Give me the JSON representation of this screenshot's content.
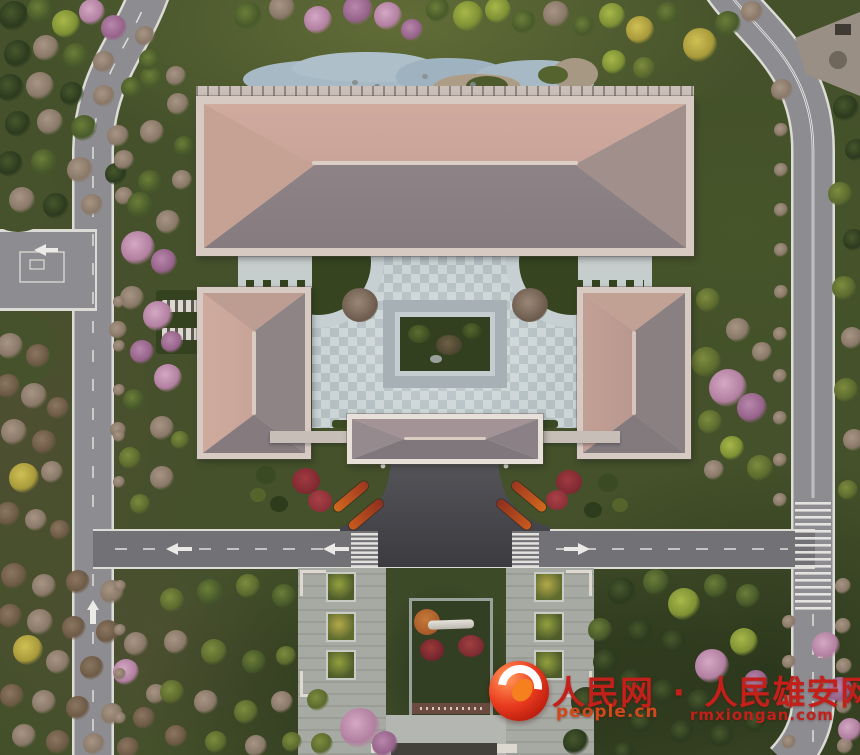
{
  "watermark": {
    "brand_left": "人民网",
    "separator": "·",
    "brand_right": "人民雄安网",
    "site_left": "people.cn",
    "site_right": "rmxiongan.com",
    "red": "#c3201b",
    "orange": "#d0491d"
  },
  "scene": {
    "subject": "Dusk aerial view of a traditional hip-roof hall compound with courtyard, gate pavilion, pond, south memorial lawn and perimeter roads",
    "elements": {
      "main_hall": "large hip-roof main hall",
      "west_wing": "west wing hall",
      "east_wing": "east wing hall",
      "gate_pavilion": "entrance gate pavilion",
      "courtyard": "checker-paved courtyard with sunken central garden",
      "pond": "curved landscape pond",
      "memorial": "south lawn with white stone monument and red shrubs",
      "roads": "loop road, T-junctions, zebra crosswalks, lane arrows"
    },
    "colors": {
      "lawn": "#44512a",
      "road": "#8d8c90",
      "road_dark": "#727176",
      "asphalt_drive": "#45444a",
      "roof_lit": "#c9a395",
      "roof_shade": "#8e8385",
      "eave": "#d6cac3",
      "paving": "#c4ced1",
      "water": "#a7b9c4",
      "flower_red": "#8e2f35",
      "flower_orange": "#c8541e"
    }
  },
  "trees": {
    "palette": [
      {
        "base": "#2c3a1e",
        "hi": "#47582c"
      },
      {
        "base": "#485a2a",
        "hi": "#6c7e38"
      },
      {
        "base": "#7e9034",
        "hi": "#a8b84a"
      },
      {
        "base": "#a89a3a",
        "hi": "#cfc055"
      },
      {
        "base": "#b27fa0",
        "hi": "#d4a8c4"
      },
      {
        "base": "#96628a",
        "hi": "#b887ab"
      },
      {
        "base": "#6d5a46",
        "hi": "#8b7660"
      },
      {
        "base": "#a05526",
        "hi": "#c47a3a"
      },
      {
        "base": "#5c6a2e",
        "hi": "#7d8c3e"
      },
      {
        "base": "#897868",
        "hi": "#a89584"
      }
    ],
    "items": [
      [
        14,
        16,
        15,
        0
      ],
      [
        40,
        10,
        13,
        1
      ],
      [
        66,
        24,
        14,
        2
      ],
      [
        92,
        12,
        13,
        4
      ],
      [
        114,
        28,
        13,
        5
      ],
      [
        18,
        54,
        14,
        0
      ],
      [
        46,
        48,
        13,
        9
      ],
      [
        76,
        56,
        13,
        1
      ],
      [
        104,
        62,
        11,
        9
      ],
      [
        10,
        88,
        14,
        0
      ],
      [
        40,
        86,
        14,
        9
      ],
      [
        72,
        94,
        12,
        0
      ],
      [
        104,
        96,
        11,
        9
      ],
      [
        132,
        88,
        11,
        1
      ],
      [
        18,
        124,
        13,
        0
      ],
      [
        50,
        122,
        13,
        9
      ],
      [
        84,
        128,
        13,
        1
      ],
      [
        118,
        136,
        11,
        9
      ],
      [
        10,
        164,
        13,
        0
      ],
      [
        44,
        162,
        13,
        1
      ],
      [
        80,
        170,
        13,
        9
      ],
      [
        116,
        174,
        11,
        0
      ],
      [
        22,
        200,
        13,
        9
      ],
      [
        56,
        206,
        13,
        0
      ],
      [
        92,
        205,
        11,
        9
      ],
      [
        145,
        36,
        10,
        9
      ],
      [
        152,
        78,
        12,
        1
      ],
      [
        178,
        104,
        11,
        9
      ],
      [
        152,
        132,
        12,
        9
      ],
      [
        184,
        146,
        10,
        1
      ],
      [
        124,
        160,
        10,
        9
      ],
      [
        150,
        182,
        12,
        1
      ],
      [
        182,
        180,
        10,
        9
      ],
      [
        150,
        60,
        11,
        1
      ],
      [
        176,
        76,
        10,
        9
      ],
      [
        124,
        196,
        9,
        9
      ],
      [
        140,
        205,
        13,
        1
      ],
      [
        168,
        222,
        12,
        9
      ],
      [
        138,
        248,
        17,
        4
      ],
      [
        164,
        262,
        13,
        5
      ],
      [
        132,
        298,
        12,
        9
      ],
      [
        158,
        316,
        15,
        4
      ],
      [
        172,
        342,
        11,
        5
      ],
      [
        142,
        352,
        12,
        5
      ],
      [
        168,
        378,
        14,
        4
      ],
      [
        134,
        400,
        11,
        1
      ],
      [
        162,
        428,
        12,
        9
      ],
      [
        130,
        458,
        11,
        8
      ],
      [
        162,
        478,
        12,
        9
      ],
      [
        140,
        504,
        10,
        8
      ],
      [
        180,
        440,
        9,
        8
      ],
      [
        118,
        430,
        8,
        9
      ],
      [
        118,
        330,
        9,
        9
      ],
      [
        10,
        346,
        13,
        9
      ],
      [
        38,
        356,
        12,
        6
      ],
      [
        8,
        386,
        12,
        6
      ],
      [
        34,
        396,
        13,
        9
      ],
      [
        58,
        408,
        11,
        6
      ],
      [
        14,
        432,
        13,
        9
      ],
      [
        44,
        442,
        12,
        6
      ],
      [
        24,
        478,
        15,
        3
      ],
      [
        52,
        472,
        11,
        9
      ],
      [
        8,
        514,
        12,
        6
      ],
      [
        36,
        520,
        11,
        9
      ],
      [
        60,
        530,
        10,
        6
      ],
      [
        248,
        16,
        14,
        1
      ],
      [
        282,
        8,
        13,
        9
      ],
      [
        318,
        20,
        14,
        4
      ],
      [
        358,
        10,
        15,
        5
      ],
      [
        388,
        16,
        14,
        4
      ],
      [
        412,
        30,
        11,
        5
      ],
      [
        438,
        10,
        12,
        1
      ],
      [
        468,
        16,
        15,
        2
      ],
      [
        498,
        10,
        13,
        2
      ],
      [
        524,
        22,
        12,
        1
      ],
      [
        556,
        14,
        13,
        9
      ],
      [
        584,
        26,
        11,
        1
      ],
      [
        612,
        16,
        13,
        2
      ],
      [
        640,
        30,
        14,
        3
      ],
      [
        668,
        14,
        12,
        1
      ],
      [
        700,
        45,
        17,
        3
      ],
      [
        728,
        24,
        13,
        1
      ],
      [
        752,
        12,
        11,
        9
      ],
      [
        614,
        62,
        12,
        2
      ],
      [
        644,
        68,
        11,
        8
      ],
      [
        782,
        90,
        11,
        9
      ],
      [
        846,
        108,
        13,
        0
      ],
      [
        856,
        150,
        11,
        0
      ],
      [
        840,
        194,
        12,
        8
      ],
      [
        854,
        240,
        11,
        0
      ],
      [
        844,
        288,
        12,
        8
      ],
      [
        852,
        338,
        11,
        9
      ],
      [
        846,
        390,
        12,
        8
      ],
      [
        854,
        440,
        11,
        9
      ],
      [
        848,
        490,
        10,
        8
      ],
      [
        781,
        130,
        7,
        9
      ],
      [
        781,
        170,
        7,
        9
      ],
      [
        781,
        210,
        7,
        9
      ],
      [
        781,
        250,
        7,
        9
      ],
      [
        781,
        292,
        7,
        9
      ],
      [
        780,
        334,
        7,
        9
      ],
      [
        780,
        376,
        7,
        9
      ],
      [
        780,
        418,
        7,
        9
      ],
      [
        780,
        460,
        7,
        9
      ],
      [
        780,
        500,
        7,
        9
      ],
      [
        708,
        300,
        12,
        8
      ],
      [
        738,
        330,
        12,
        9
      ],
      [
        762,
        352,
        10,
        9
      ],
      [
        706,
        362,
        15,
        8
      ],
      [
        728,
        388,
        19,
        4
      ],
      [
        752,
        408,
        15,
        5
      ],
      [
        710,
        422,
        12,
        8
      ],
      [
        732,
        448,
        12,
        2
      ],
      [
        760,
        468,
        13,
        8
      ],
      [
        714,
        470,
        10,
        9
      ],
      [
        14,
        576,
        13,
        6
      ],
      [
        44,
        586,
        12,
        9
      ],
      [
        78,
        582,
        12,
        6
      ],
      [
        112,
        592,
        12,
        9
      ],
      [
        10,
        616,
        12,
        6
      ],
      [
        40,
        622,
        13,
        9
      ],
      [
        74,
        628,
        12,
        6
      ],
      [
        108,
        632,
        12,
        6
      ],
      [
        136,
        644,
        12,
        9
      ],
      [
        28,
        650,
        15,
        3
      ],
      [
        58,
        662,
        12,
        9
      ],
      [
        92,
        668,
        12,
        6
      ],
      [
        126,
        672,
        13,
        4
      ],
      [
        12,
        696,
        12,
        6
      ],
      [
        44,
        702,
        12,
        9
      ],
      [
        78,
        708,
        12,
        6
      ],
      [
        112,
        714,
        11,
        9
      ],
      [
        144,
        718,
        11,
        6
      ],
      [
        24,
        736,
        12,
        9
      ],
      [
        58,
        742,
        12,
        6
      ],
      [
        94,
        744,
        11,
        9
      ],
      [
        128,
        748,
        11,
        6
      ],
      [
        156,
        694,
        10,
        9
      ],
      [
        172,
        600,
        12,
        8
      ],
      [
        210,
        592,
        13,
        1
      ],
      [
        248,
        586,
        12,
        8
      ],
      [
        284,
        596,
        12,
        1
      ],
      [
        176,
        642,
        12,
        9
      ],
      [
        214,
        652,
        13,
        8
      ],
      [
        254,
        662,
        12,
        1
      ],
      [
        286,
        656,
        10,
        8
      ],
      [
        172,
        692,
        12,
        8
      ],
      [
        206,
        702,
        12,
        9
      ],
      [
        246,
        712,
        12,
        8
      ],
      [
        282,
        702,
        11,
        9
      ],
      [
        176,
        736,
        11,
        6
      ],
      [
        216,
        742,
        11,
        8
      ],
      [
        256,
        746,
        11,
        9
      ],
      [
        292,
        742,
        10,
        8
      ],
      [
        318,
        700,
        11,
        8
      ],
      [
        360,
        728,
        20,
        4
      ],
      [
        385,
        744,
        13,
        5
      ],
      [
        322,
        744,
        11,
        8
      ],
      [
        622,
        592,
        14,
        0
      ],
      [
        656,
        582,
        13,
        1
      ],
      [
        684,
        604,
        16,
        2
      ],
      [
        716,
        586,
        12,
        1
      ],
      [
        748,
        596,
        12,
        1
      ],
      [
        640,
        632,
        13,
        0
      ],
      [
        674,
        642,
        13,
        0
      ],
      [
        744,
        642,
        14,
        2
      ],
      [
        712,
        666,
        17,
        4
      ],
      [
        756,
        682,
        12,
        5
      ],
      [
        632,
        682,
        13,
        0
      ],
      [
        664,
        692,
        13,
        0
      ],
      [
        700,
        702,
        13,
        0
      ],
      [
        642,
        722,
        12,
        0
      ],
      [
        682,
        732,
        12,
        0
      ],
      [
        722,
        736,
        12,
        0
      ],
      [
        756,
        722,
        11,
        0
      ],
      [
        624,
        752,
        10,
        0
      ],
      [
        586,
        702,
        15,
        0
      ],
      [
        576,
        742,
        13,
        0
      ],
      [
        606,
        662,
        13,
        0
      ],
      [
        600,
        630,
        12,
        1
      ],
      [
        789,
        622,
        7,
        9
      ],
      [
        789,
        662,
        7,
        9
      ],
      [
        789,
        702,
        7,
        9
      ],
      [
        789,
        742,
        7,
        9
      ],
      [
        843,
        586,
        8,
        9
      ],
      [
        843,
        626,
        8,
        9
      ],
      [
        844,
        666,
        8,
        9
      ],
      [
        844,
        706,
        8,
        9
      ],
      [
        845,
        746,
        8,
        9
      ],
      [
        826,
        646,
        14,
        4
      ],
      [
        840,
        690,
        13,
        5
      ],
      [
        850,
        730,
        12,
        4
      ],
      [
        119,
        302,
        6,
        9
      ],
      [
        119,
        346,
        6,
        9
      ],
      [
        119,
        390,
        6,
        9
      ],
      [
        119,
        436,
        6,
        9
      ],
      [
        119,
        482,
        6,
        9
      ],
      [
        120,
        586,
        6,
        9
      ],
      [
        120,
        630,
        6,
        9
      ],
      [
        120,
        674,
        6,
        9
      ],
      [
        120,
        718,
        6,
        9
      ]
    ]
  }
}
